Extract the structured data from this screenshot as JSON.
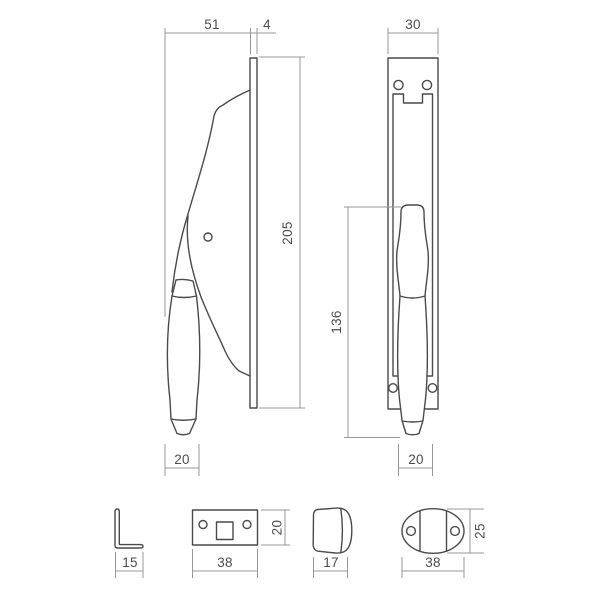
{
  "drawing": {
    "background": "#ffffff",
    "object_line_color": "#4a4a4a",
    "dimension_line_color": "#979797",
    "text_color": "#4d4d4d",
    "views": {
      "side_view": {
        "dims": {
          "depth": "51",
          "plate_thickness": "4",
          "plate_height": "205",
          "grip_width": "20"
        }
      },
      "front_view": {
        "dims": {
          "plate_width": "30",
          "handle_length": "136",
          "grip_width": "20"
        }
      },
      "angle_bracket": {
        "dims": {
          "width": "15"
        }
      },
      "strike_plate": {
        "dims": {
          "width": "38",
          "height": "20"
        }
      },
      "cap": {
        "dims": {
          "width": "17"
        }
      },
      "oval_keeper": {
        "dims": {
          "width": "38",
          "height": "25"
        }
      }
    }
  }
}
